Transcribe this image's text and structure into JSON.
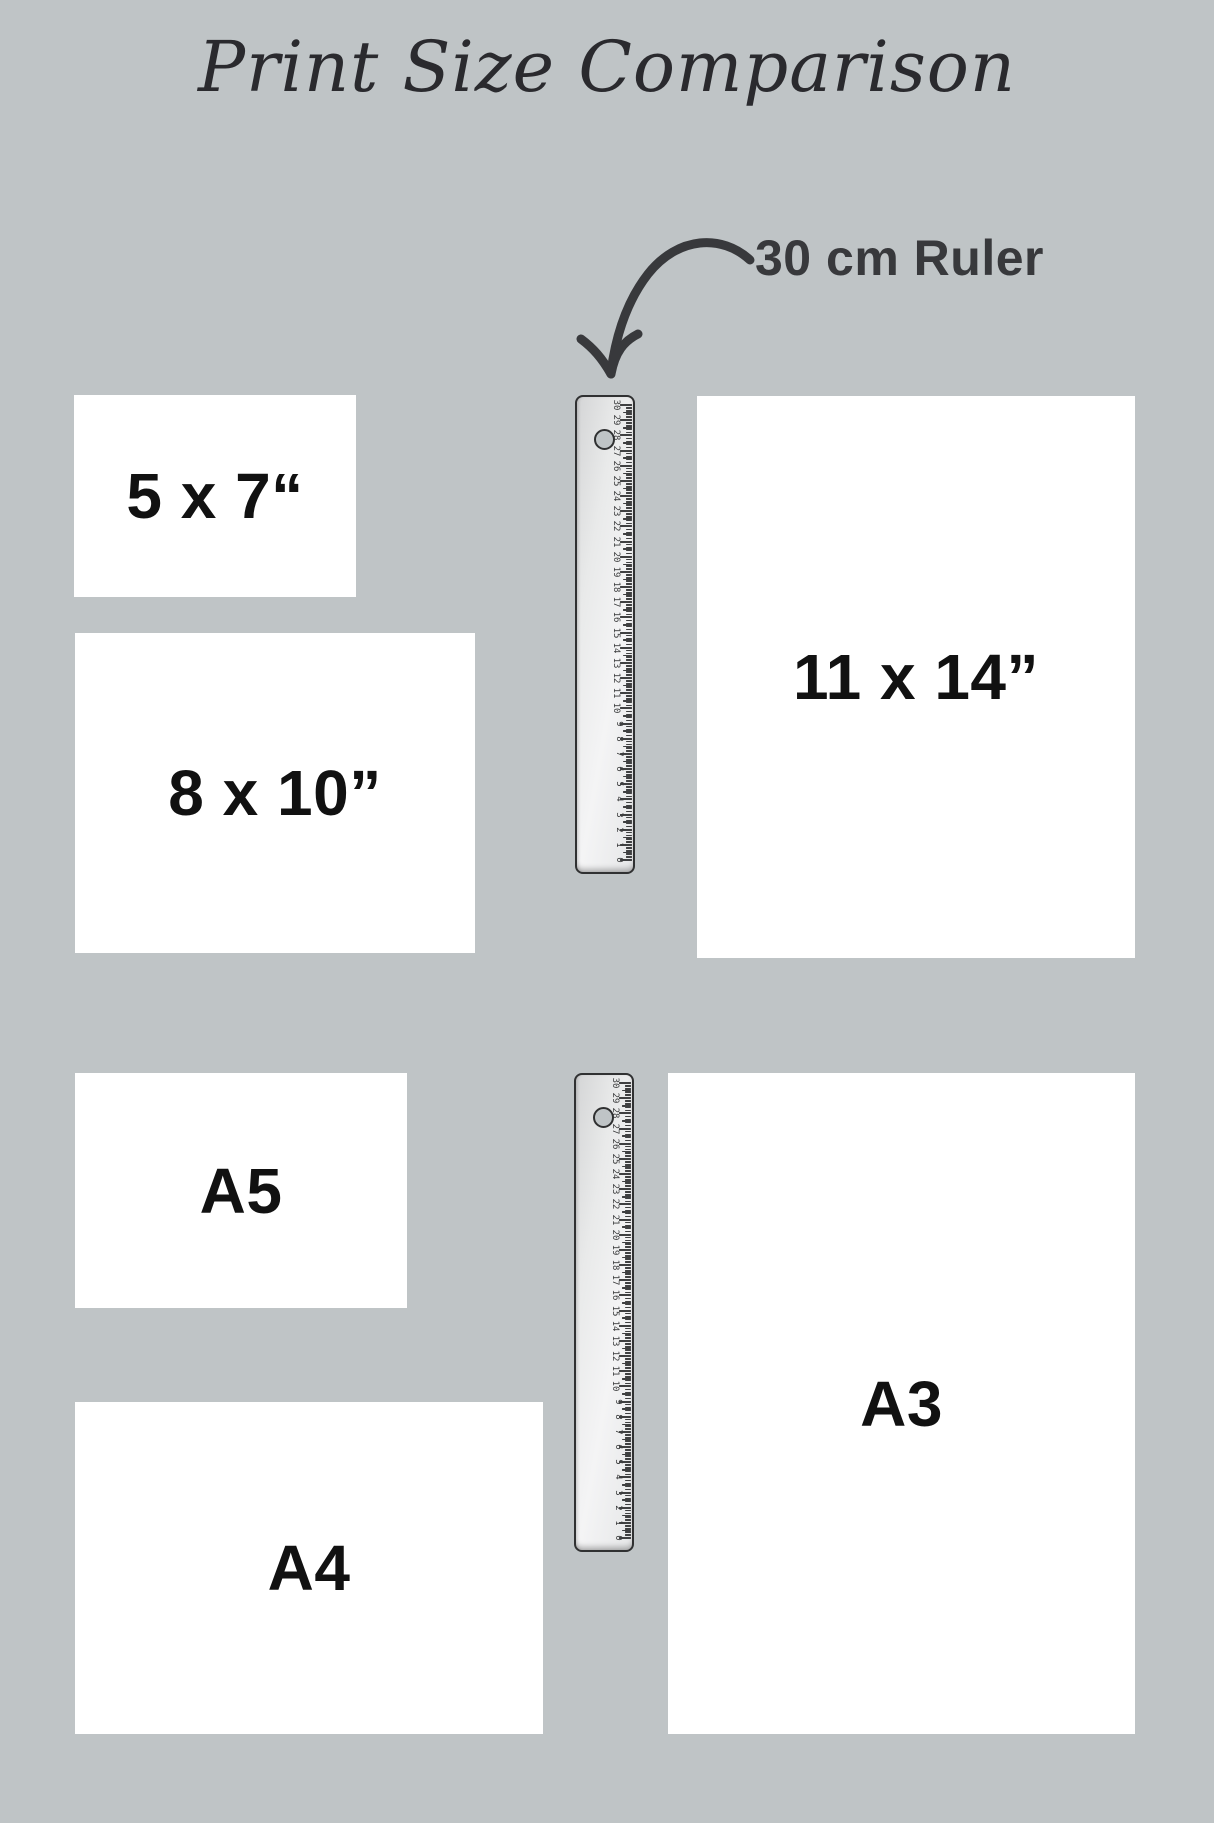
{
  "title": "Print Size Comparison",
  "annotation": {
    "label": "30 cm Ruler"
  },
  "prints": [
    {
      "id": "5x7",
      "label": "5 x 7“"
    },
    {
      "id": "8x10",
      "label": "8 x 10”"
    },
    {
      "id": "11x14",
      "label": "11 x 14”"
    },
    {
      "id": "a5",
      "label": "A5"
    },
    {
      "id": "a4",
      "label": "A4"
    },
    {
      "id": "a3",
      "label": "A3"
    }
  ],
  "ruler": {
    "cm_max": 30,
    "unit": "cm",
    "count": 2
  },
  "colors": {
    "background": "#bfc4c6",
    "paper": "#ffffff",
    "ink": "#111111",
    "annotation_ink": "#38393c",
    "title_ink": "#2a2a2e",
    "ruler_border": "#303132",
    "tick": "#3f4041",
    "ruler_num": "#3a3b3c"
  }
}
